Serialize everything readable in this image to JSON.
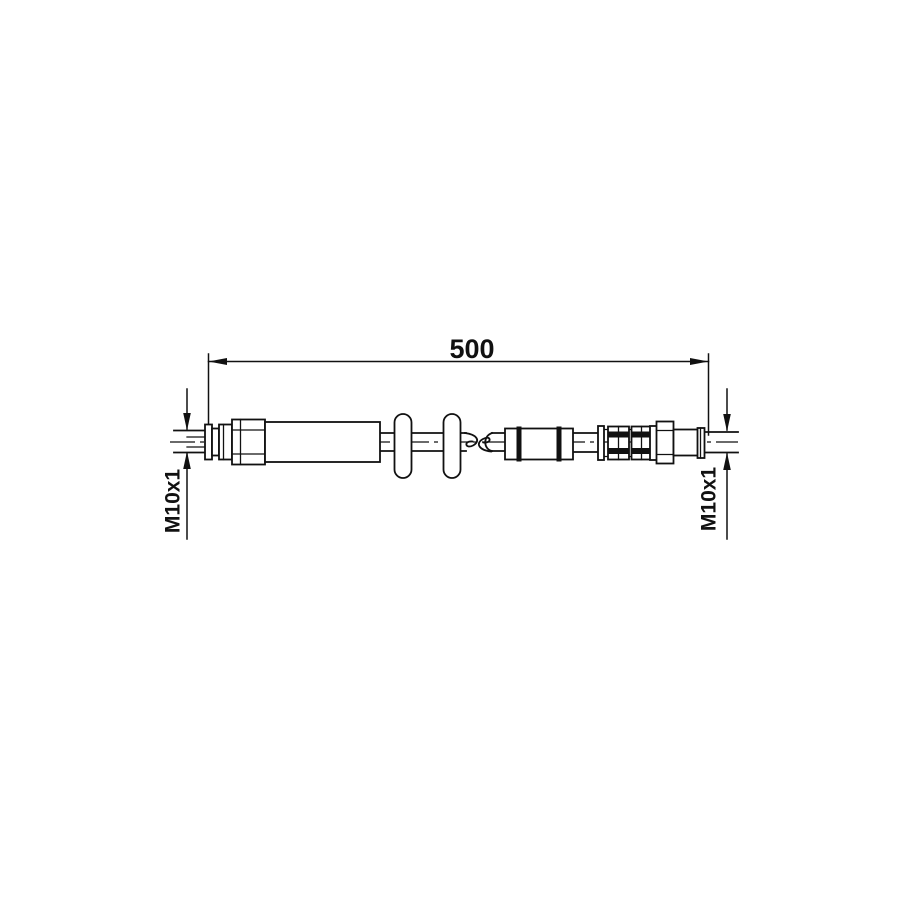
{
  "drawing": {
    "kind": "brake-hose-technical-drawing",
    "length_dimension": "500",
    "left_thread_label": "M10x1",
    "right_thread_label": "M10x1",
    "line_color": "#111111",
    "background_color": "#ffffff"
  }
}
